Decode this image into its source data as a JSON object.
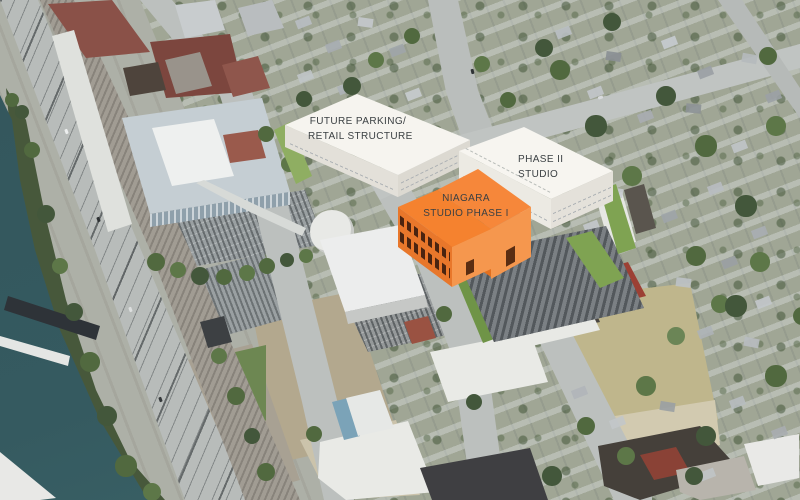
{
  "scene": {
    "description": "Aerial bird's-eye rendering of a proposed studio development beside a river, rail corridor and expressway, with three massing models overlaid on aerial photography"
  },
  "annotations": {
    "future_parking": {
      "line1": "FUTURE PARKING/",
      "line2": "RETAIL STRUCTURE"
    },
    "phase1": {
      "line1": "NIAGARA",
      "line2": "STUDIO PHASE I"
    },
    "phase2": {
      "line1": "PHASE II",
      "line2": "STUDIO"
    }
  },
  "palette": {
    "phase1_orange": "#f0823a",
    "massing_white": "#f6f4ef",
    "label_text": "#3b4043",
    "river_water": "#355a60",
    "grass_green": "#7fa352",
    "proposed_parking_gray": "#6d7276"
  }
}
